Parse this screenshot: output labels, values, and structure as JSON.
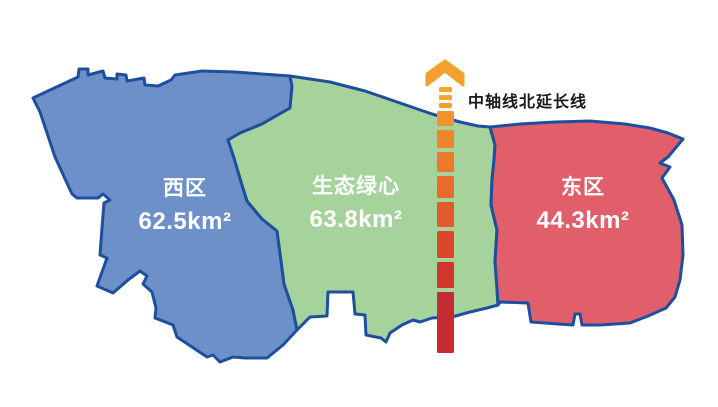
{
  "map": {
    "outline_color": "#1D4F9E",
    "background": "#FFFFFF",
    "regions": {
      "west": {
        "name": "西区",
        "area": "62.5km²",
        "color": "#6D90C9"
      },
      "green_heart": {
        "name": "生态绿心",
        "area": "63.8km²",
        "color": "#A6D39B"
      },
      "east": {
        "name": "东区",
        "area": "44.3km²",
        "color": "#E05F6A"
      }
    }
  },
  "axis": {
    "label": "中轴线北延长线",
    "label_color": "#1A1A1A",
    "arrow_color": "#F2A12F",
    "center_x": 445,
    "dashes": [
      {
        "y": 87,
        "h": 5,
        "w": 13,
        "color": "#F5A42C"
      },
      {
        "y": 95,
        "h": 5,
        "w": 13,
        "color": "#F5A42C"
      },
      {
        "y": 103,
        "h": 5,
        "w": 13,
        "color": "#F39D2D"
      },
      {
        "y": 111,
        "h": 15,
        "w": 17,
        "color": "#F0932D"
      },
      {
        "y": 130,
        "h": 18,
        "w": 17,
        "color": "#EE862E"
      },
      {
        "y": 152,
        "h": 20,
        "w": 17,
        "color": "#EC7A2E"
      },
      {
        "y": 176,
        "h": 22,
        "w": 17,
        "color": "#E86B2E"
      },
      {
        "y": 202,
        "h": 25,
        "w": 17,
        "color": "#E25A2E"
      },
      {
        "y": 231,
        "h": 27,
        "w": 17,
        "color": "#DA472D"
      },
      {
        "y": 262,
        "h": 26,
        "w": 17,
        "color": "#D1362D"
      },
      {
        "y": 292,
        "h": 61,
        "w": 17,
        "color": "#C52B33"
      }
    ]
  }
}
